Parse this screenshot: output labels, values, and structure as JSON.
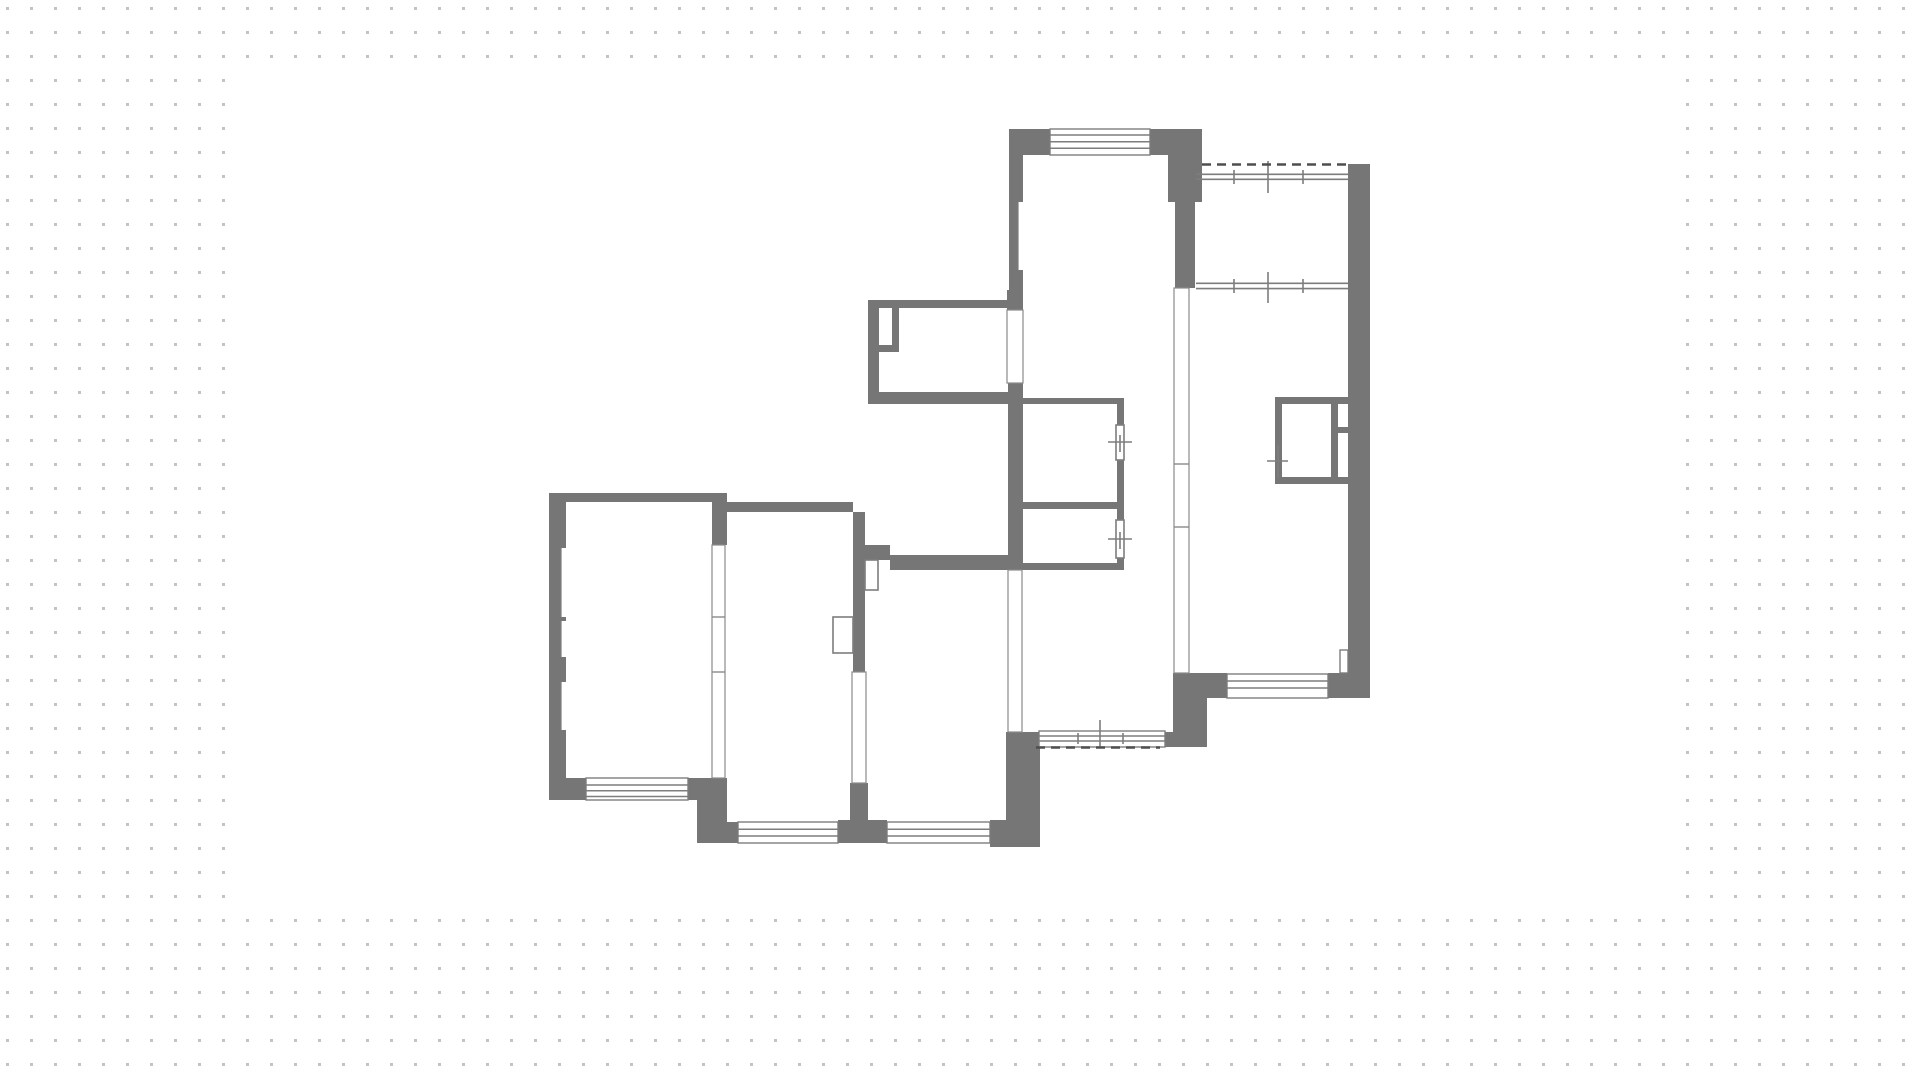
{
  "canvas": {
    "width": 1920,
    "height": 1078,
    "page_bg": "#ffffff",
    "dot_color": "#c3c3c3",
    "dot_size": 3,
    "dot_spacing": 24,
    "dot_offset_x": 6,
    "dot_offset_y": 7,
    "paper": {
      "x": 235,
      "y": 62,
      "w": 1451,
      "h": 846,
      "fill": "#ffffff"
    }
  },
  "floorplan": {
    "wall_color": "#767676",
    "line_color": "#7d7d7d",
    "partition_color": "#8a8a8a",
    "dash_color": "#4e4e4e",
    "room_fill": "#ffffff",
    "walls": [
      {
        "r": [
          1009,
          129,
          41,
          26
        ],
        "label": "living-top-wall-left"
      },
      {
        "r": [
          1150,
          129,
          52,
          26
        ],
        "label": "living-top-wall-right"
      },
      {
        "r": [
          1009,
          155,
          14,
          145
        ],
        "label": "living-left-wall"
      },
      {
        "r": [
          1168,
          155,
          34,
          47
        ],
        "label": "living-right-wall-upper"
      },
      {
        "r": [
          1175,
          202,
          20,
          86
        ],
        "label": "living-right-wall-lower"
      },
      {
        "r": [
          868,
          300,
          141,
          8
        ],
        "label": "vestibule-top-wall"
      },
      {
        "r": [
          868,
          308,
          11,
          96
        ],
        "label": "vestibule-left-wall"
      },
      {
        "r": [
          892,
          308,
          7,
          44
        ],
        "label": "vestibule-pier-vertical"
      },
      {
        "r": [
          879,
          345,
          20,
          7
        ],
        "label": "vestibule-pier-horizontal"
      },
      {
        "r": [
          868,
          392,
          140,
          12
        ],
        "label": "vestibule-bottom-wall"
      },
      {
        "r": [
          1007,
          290,
          16,
          20
        ],
        "label": "vestibule-east-wall-top"
      },
      {
        "r": [
          1008,
          383,
          15,
          187
        ],
        "label": "hall-west-wall"
      },
      {
        "r": [
          1010,
          398,
          12,
          172
        ],
        "label": "bath-left-wall"
      },
      {
        "r": [
          1022,
          398,
          101,
          6
        ],
        "label": "bath-top-wall"
      },
      {
        "r": [
          1117,
          398,
          7,
          172
        ],
        "label": "bath-right-wall"
      },
      {
        "r": [
          1022,
          502,
          101,
          7
        ],
        "label": "bath-middle-wall"
      },
      {
        "r": [
          1010,
          563,
          114,
          7
        ],
        "label": "bath-bottom-wall"
      },
      {
        "r": [
          549,
          493,
          176,
          9
        ],
        "label": "left-room-top-wall"
      },
      {
        "r": [
          549,
          502,
          17,
          298
        ],
        "label": "left-room-left-wall"
      },
      {
        "r": [
          712,
          493,
          15,
          52
        ],
        "label": "left-corner-block"
      },
      {
        "r": [
          549,
          778,
          37,
          22
        ],
        "label": "left-room-bottom-wall-west"
      },
      {
        "r": [
          688,
          778,
          39,
          22
        ],
        "label": "left-room-bottom-wall-east"
      },
      {
        "r": [
          697,
          800,
          30,
          43
        ],
        "label": "bottom-step-block"
      },
      {
        "r": [
          725,
          502,
          128,
          10
        ],
        "label": "second-room-top-wall"
      },
      {
        "r": [
          727,
          822,
          11,
          21
        ],
        "label": "second-room-bottom-strip"
      },
      {
        "r": [
          838,
          820,
          49,
          23
        ],
        "label": "bottom-window-pier"
      },
      {
        "r": [
          853,
          512,
          12,
          160
        ],
        "label": "second-third-partition-column"
      },
      {
        "r": [
          865,
          545,
          25,
          15
        ],
        "label": "third-room-top-step"
      },
      {
        "r": [
          850,
          783,
          18,
          45
        ],
        "label": "second-third-partition-foot"
      },
      {
        "r": [
          890,
          555,
          118,
          15
        ],
        "label": "third-room-top-wall"
      },
      {
        "r": [
          990,
          820,
          50,
          27
        ],
        "label": "third-room-corner-east"
      },
      {
        "r": [
          1006,
          732,
          34,
          115
        ],
        "label": "third-room-right-wall"
      },
      {
        "r": [
          1165,
          732,
          42,
          15
        ],
        "label": "hall-bottom-corner-east"
      },
      {
        "r": [
          1173,
          673,
          34,
          73
        ],
        "label": "hall-right-connector"
      },
      {
        "r": [
          1173,
          673,
          54,
          25
        ],
        "label": "right-room-bottom-corner-west"
      },
      {
        "r": [
          1328,
          673,
          42,
          25
        ],
        "label": "right-room-bottom-corner-east"
      },
      {
        "r": [
          1348,
          164,
          22,
          534
        ],
        "label": "right-room-right-wall"
      },
      {
        "r": [
          1275,
          397,
          75,
          7
        ],
        "label": "closet-top"
      },
      {
        "r": [
          1275,
          477,
          75,
          7
        ],
        "label": "closet-bottom"
      },
      {
        "r": [
          1275,
          404,
          7,
          73
        ],
        "label": "closet-left"
      },
      {
        "r": [
          1331,
          404,
          7,
          73
        ],
        "label": "closet-divider-vertical"
      },
      {
        "r": [
          1338,
          427,
          12,
          6
        ],
        "label": "closet-divider-horizontal"
      }
    ],
    "windows": [
      {
        "r": [
          1050,
          129,
          100,
          26
        ],
        "lines_y": [
          135,
          141.7,
          148.3
        ],
        "label": "window-living-top"
      },
      {
        "r": [
          586,
          778,
          102,
          22
        ],
        "lines_y": [
          785,
          790.7,
          796.5
        ],
        "label": "window-left-room-bottom"
      },
      {
        "r": [
          738,
          822,
          100,
          21
        ],
        "lines_y": [
          829.3,
          836
        ],
        "label": "window-second-room-bottom"
      },
      {
        "r": [
          887,
          822,
          103,
          21
        ],
        "lines_y": [
          829.3,
          836
        ],
        "label": "window-third-room-bottom"
      },
      {
        "r": [
          1227,
          674,
          101,
          24
        ],
        "lines_y": [
          681,
          688
        ],
        "label": "window-right-room-bottom"
      },
      {
        "r": [
          1039,
          731,
          126,
          16
        ],
        "lines_y": [
          736,
          741
        ],
        "label": "window-hall-bottom"
      }
    ],
    "partitions": [
      {
        "r": [
          712,
          545,
          13,
          233
        ],
        "dividers_y": [
          617,
          672
        ],
        "label": "partition-left-second"
      },
      {
        "r": [
          852,
          672,
          14,
          111
        ],
        "dividers_y": [],
        "label": "partition-second-third"
      },
      {
        "r": [
          1008,
          570,
          14,
          162
        ],
        "dividers_y": [],
        "label": "partition-hall-third"
      },
      {
        "r": [
          1174,
          288,
          15,
          385
        ],
        "dividers_y": [
          464,
          527
        ],
        "label": "partition-hall-right-room"
      },
      {
        "r": [
          1007,
          310,
          16,
          73
        ],
        "dividers_y": [],
        "label": "opening-vestibule-living"
      }
    ],
    "doors": [
      {
        "r": [
          865,
          560,
          13,
          30
        ],
        "label": "door-leaf-third-room"
      },
      {
        "r": [
          833,
          617,
          20,
          36
        ],
        "label": "door-leaf-second-room"
      },
      {
        "r": [
          1116,
          425,
          8,
          35
        ],
        "label": "door-leaf-bath"
      },
      {
        "r": [
          1116,
          520,
          8,
          38
        ],
        "label": "door-leaf-wc"
      }
    ],
    "niches": [
      {
        "r": [
          1018,
          202,
          5,
          68
        ],
        "outline": "left",
        "label": "niche-living-left-wall"
      },
      {
        "r": [
          561,
          548,
          6,
          69
        ],
        "outline": "left",
        "label": "niche-left-wall-1"
      },
      {
        "r": [
          561,
          621,
          6,
          36
        ],
        "outline": "left",
        "label": "niche-left-wall-2"
      },
      {
        "r": [
          561,
          682,
          6,
          48
        ],
        "outline": "left",
        "label": "niche-left-wall-3"
      },
      {
        "r": [
          1340,
          650,
          8,
          23
        ],
        "outline": "full",
        "label": "niche-right-corner"
      }
    ],
    "marks": [
      [
        1108,
        442,
        1132,
        442
      ],
      [
        1120,
        435,
        1120,
        452
      ],
      [
        1108,
        539,
        1132,
        539
      ],
      [
        1120,
        532,
        1120,
        549
      ],
      [
        1267,
        461,
        1288,
        461
      ],
      [
        1278,
        445,
        1278,
        478
      ],
      [
        1234,
        170,
        1234,
        184
      ],
      [
        1303,
        170,
        1303,
        184
      ],
      [
        1268,
        161,
        1268,
        193
      ],
      [
        1234,
        279,
        1234,
        293
      ],
      [
        1303,
        279,
        1303,
        293
      ],
      [
        1268,
        272,
        1268,
        303
      ],
      [
        1078,
        733,
        1078,
        744
      ],
      [
        1123,
        733,
        1123,
        744
      ],
      [
        1100,
        720,
        1100,
        747
      ],
      [
        1196,
        174.3,
        1348,
        174.3
      ],
      [
        1196,
        179.3,
        1348,
        179.3
      ],
      [
        1196,
        283.3,
        1348,
        283.3
      ],
      [
        1196,
        288.6,
        1348,
        288.6
      ]
    ],
    "dashes": [
      [
        1202,
        164.5,
        1348,
        164.5
      ],
      [
        1036,
        747.5,
        1160,
        747.5
      ]
    ]
  }
}
